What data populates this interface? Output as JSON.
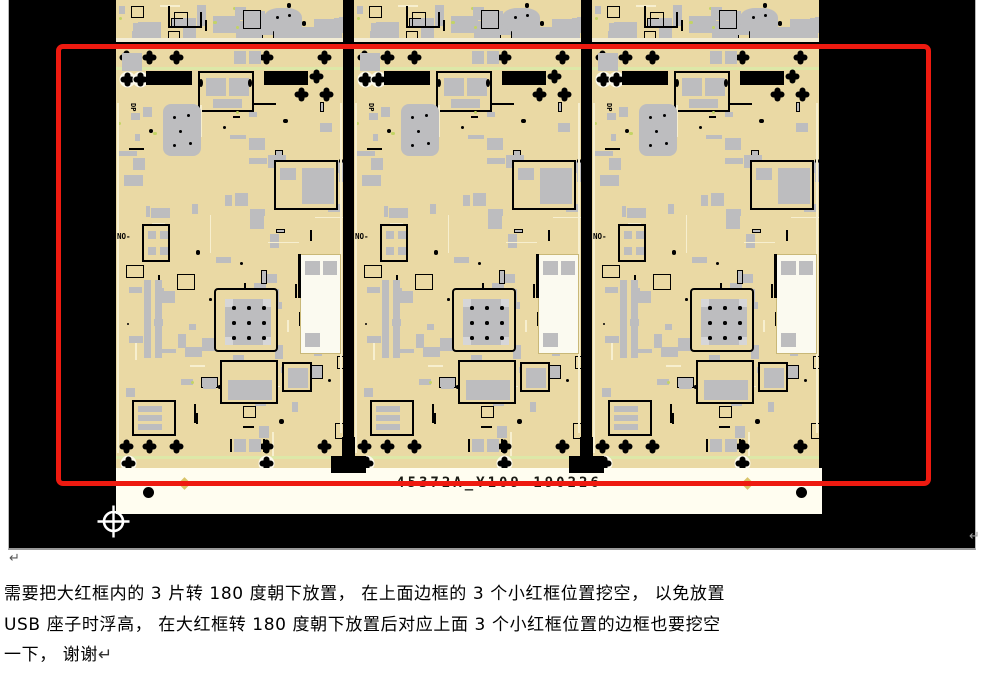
{
  "document": {
    "background": "#ffffff",
    "pilcrow_after_image": "↵",
    "pilcrow_inline": "↵",
    "instruction_lines": [
      "需要把大红框内的 3 片转 180 度朝下放置， 在上面边框的 3 个小红框位置挖空， 以免放置",
      "USB 座子时浮高， 在大红框转 180 度朝下放置后对应上面 3 个小红框位置的边框也要挖空",
      "一下， 谢谢"
    ]
  },
  "panel_image": {
    "board_count": 3,
    "panel_label": "45372A_Y109-190226",
    "silkscreen": {
      "dp_label": "DP",
      "on_label": "NO-"
    },
    "trailing_return_mark": "↵",
    "colors": {
      "background": "#000000",
      "board_tan": "#ead9a4",
      "trace_light": "#f7efcf",
      "component_gray": "#bdbdbf",
      "pad_gray": "#d6d6d8",
      "green_dot": "#c3d465",
      "edge_green": "#dde8a8",
      "rail_white": "#fffdf0",
      "red_frame": "#ee1a10",
      "fiducial_yellow": "#d9c469",
      "white_area": "#fbfaf0"
    }
  }
}
